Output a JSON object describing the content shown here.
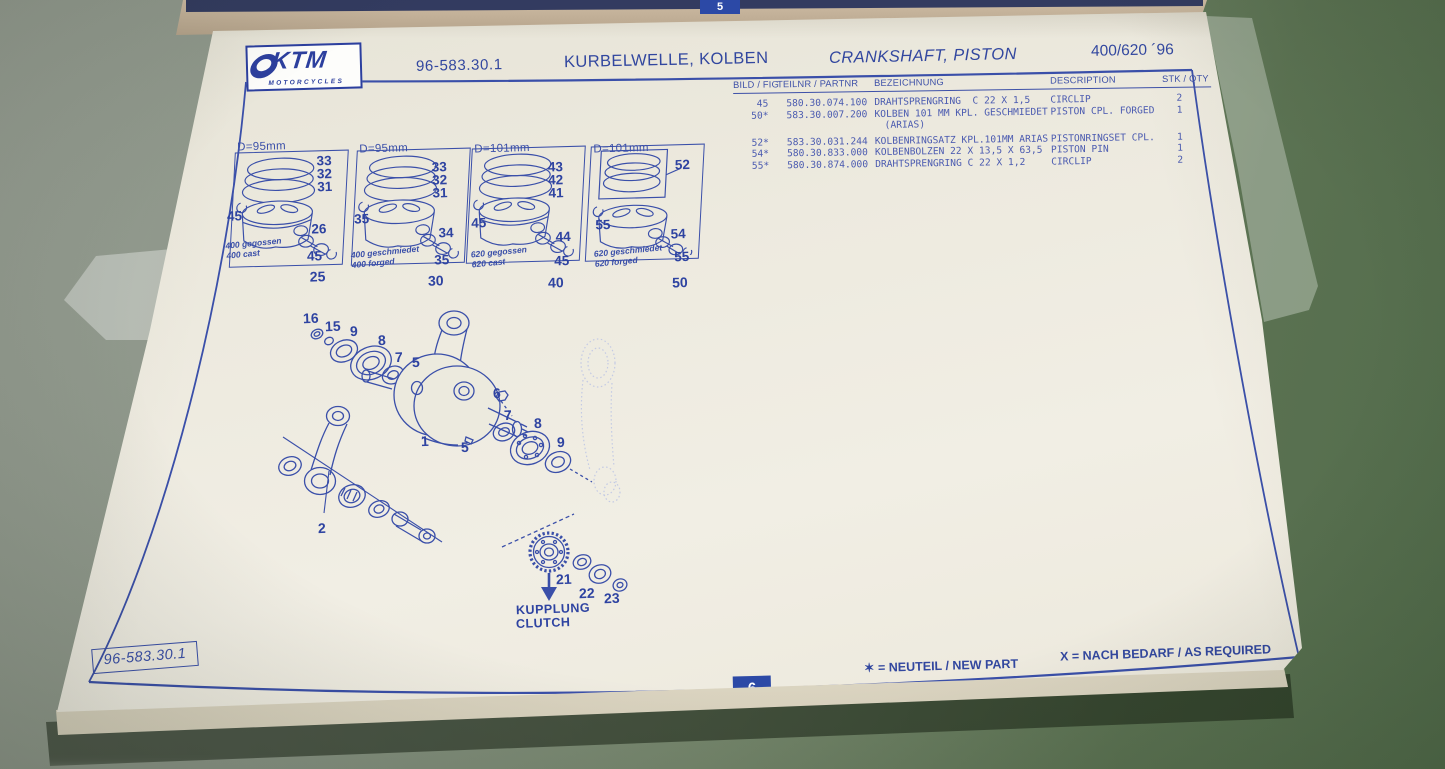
{
  "prev_page": {
    "page_number": "5"
  },
  "header": {
    "logo": {
      "brand": "KTM",
      "sub": "MOTORCYCLES"
    },
    "doc_number": "96-583.30.1",
    "title_de": "KURBELWELLE, KOLBEN",
    "title_en": "CRANKSHAFT, PISTON",
    "model": "400/620 ´96"
  },
  "table": {
    "headers": {
      "fig": "BILD / FIG",
      "part": "TEILNR / PARTNR",
      "desc_de": "BEZEICHNUNG",
      "desc_en": "DESCRIPTION",
      "qty": "STK / QTY"
    },
    "rows": [
      {
        "fig": "45",
        "part": "580.30.074.100",
        "desc_de": "DRAHTSPRENGRING  C 22 X 1,5",
        "desc_en": "CIRCLIP",
        "qty": "2"
      },
      {
        "fig": "50*",
        "part": "583.30.007.200",
        "desc_de": "KOLBEN 101 MM KPL. GESCHMIEDET",
        "desc_en": "PISTON CPL. FORGED",
        "qty": "1"
      },
      {
        "fig": "",
        "part": "",
        "desc_de": "(ARIAS)",
        "desc_en": "",
        "qty": ""
      },
      {
        "fig": "52*",
        "part": "583.30.031.244",
        "desc_de": "KOLBENRINGSATZ KPL.101MM ARIAS",
        "desc_en": "PISTONRINGSET CPL.",
        "qty": "1"
      },
      {
        "fig": "54*",
        "part": "580.30.833.000",
        "desc_de": "KOLBENBOLZEN 22 X 13,5 X 63,5",
        "desc_en": "PISTON PIN",
        "qty": "1"
      },
      {
        "fig": "55*",
        "part": "580.30.874.000",
        "desc_de": "DRAHTSPRENGRING C 22 X 1,2",
        "desc_en": "CIRCLIP",
        "qty": "2"
      }
    ]
  },
  "panels": [
    {
      "diameter": "D=95mm",
      "ring_labels": [
        "33",
        "32",
        "31"
      ],
      "circlip_left": "45",
      "pin_label": "26",
      "circlip_right": "45",
      "caption_de": "400 gegossen",
      "caption_en": "400 cast",
      "assembly_number": "25"
    },
    {
      "diameter": "D=95mm",
      "ring_labels": [
        "33",
        "32",
        "31"
      ],
      "circlip_left": "35",
      "pin_label": "34",
      "circlip_right": "35",
      "caption_de": "400 geschmiedet",
      "caption_en": "400 forged",
      "assembly_number": "30"
    },
    {
      "diameter": "D=101mm",
      "ring_labels": [
        "43",
        "42",
        "41"
      ],
      "circlip_left": "45",
      "pin_label": "44",
      "circlip_right": "45",
      "caption_de": "620 gegossen",
      "caption_en": "620 cast",
      "assembly_number": "40"
    },
    {
      "diameter": "D=101mm",
      "ringset_label": "52",
      "circlip_left": "55",
      "pin_label": "54",
      "circlip_right": "55",
      "caption_de": "620 geschmiedet",
      "caption_en": "620 forged",
      "assembly_number": "50"
    }
  ],
  "diagram": {
    "labels": [
      "16",
      "15",
      "9",
      "8",
      "7",
      "5",
      "1",
      "5",
      "6",
      "7",
      "8",
      "9",
      "2",
      "21",
      "22",
      "23"
    ],
    "clutch_caption_de": "KUPPLUNG",
    "clutch_caption_en": "CLUTCH"
  },
  "footer": {
    "doc_number": "96-583.30.1",
    "page_number": "6",
    "legend_new": "✶ = NEUTEIL / NEW PART",
    "legend_required": "X = NACH BEDARF / AS REQUIRED"
  },
  "colors": {
    "ink_blue": "#3a4fa9",
    "paper": "#eeebe0",
    "table_surface_green": "#6d7e65",
    "page_tab_blue": "#2c49a6"
  }
}
